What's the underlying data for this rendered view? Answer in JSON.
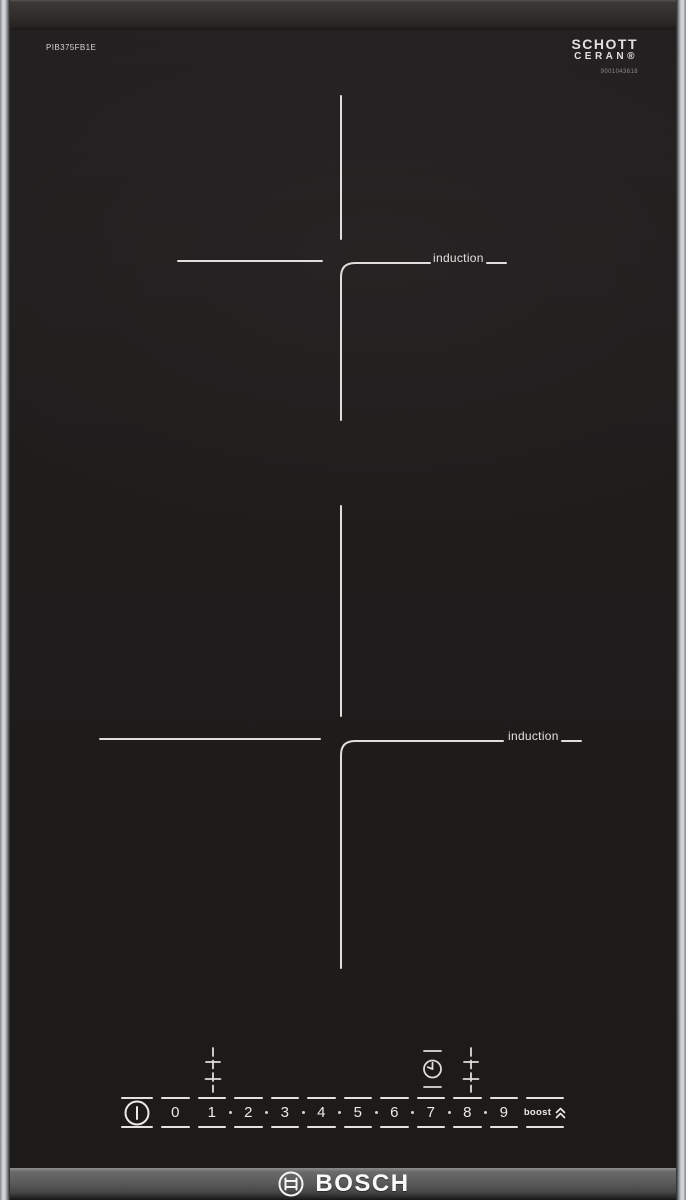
{
  "device": {
    "model": "PIB375FB1E",
    "brand": "BOSCH"
  },
  "glass_branding": {
    "line1": "SCHOTT",
    "line2": "CERAN®",
    "code": "9001043618"
  },
  "zones": [
    {
      "label": "induction"
    },
    {
      "label": "induction"
    }
  ],
  "controls": {
    "power_key_icon": "power-standby-icon",
    "levels": [
      "0",
      "1",
      "2",
      "3",
      "4",
      "5",
      "6",
      "7",
      "8",
      "9"
    ],
    "boost_label": "boost",
    "boost_icon": "double-chevron-up-icon",
    "front_zone_key_icon": "zone-select-icon",
    "timer_key_icon": "timer-clock-icon",
    "rear_zone_key_icon": "zone-select-icon"
  },
  "colors": {
    "glass": "#1f1d1c",
    "marking": "#e0dedc",
    "side_trim": "#d9dcdf",
    "bottom_band": "#5b5b5b",
    "logo_text": "#fafafa"
  }
}
